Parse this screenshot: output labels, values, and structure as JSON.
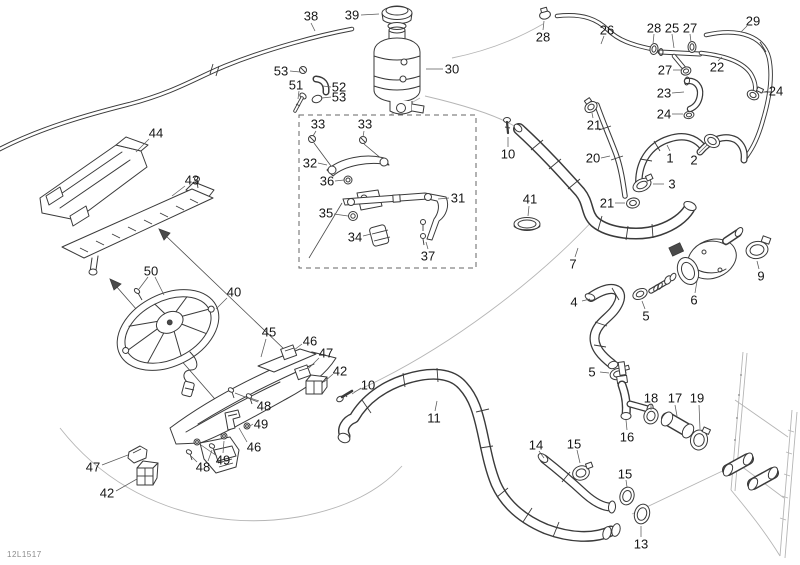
{
  "figure_code": "12L1517",
  "colors": {
    "line": "#3a3a3a",
    "label": "#161616",
    "guide": "#b5b5b5",
    "leader": "#5a5a5a",
    "background": "#ffffff"
  },
  "labels": [
    {
      "n": "38",
      "x": 311,
      "y": 16,
      "L": [
        [
          311,
          23,
          315,
          31
        ]
      ]
    },
    {
      "n": "39",
      "x": 352,
      "y": 15,
      "L": [
        [
          361,
          15,
          379,
          14
        ]
      ]
    },
    {
      "n": "30",
      "x": 452,
      "y": 69,
      "L": [
        [
          443,
          69,
          426,
          69
        ]
      ]
    },
    {
      "n": "53",
      "x": 281,
      "y": 71,
      "L": [
        [
          290,
          71,
          300,
          72
        ]
      ]
    },
    {
      "n": "51",
      "x": 296,
      "y": 85,
      "L": [
        [
          299,
          91,
          298,
          99
        ]
      ]
    },
    {
      "n": "52",
      "x": 339,
      "y": 87,
      "L": [
        [
          331,
          87,
          323,
          86
        ]
      ]
    },
    {
      "n": "53",
      "x": 339,
      "y": 97,
      "L": [
        [
          331,
          97,
          322,
          98
        ]
      ]
    },
    {
      "n": "28",
      "x": 543,
      "y": 37,
      "L": [
        [
          543,
          30,
          544,
          21
        ]
      ]
    },
    {
      "n": "26",
      "x": 607,
      "y": 30,
      "L": [
        [
          604,
          36,
          601,
          44
        ]
      ]
    },
    {
      "n": "28",
      "x": 654,
      "y": 28,
      "L": [
        [
          654,
          34,
          653,
          44
        ]
      ]
    },
    {
      "n": "25",
      "x": 672,
      "y": 28,
      "L": [
        [
          672,
          34,
          674,
          48
        ]
      ]
    },
    {
      "n": "27",
      "x": 690,
      "y": 28,
      "L": [
        [
          690,
          34,
          691,
          42
        ]
      ]
    },
    {
      "n": "29",
      "x": 753,
      "y": 21,
      "L": [
        [
          747,
          26,
          741,
          32
        ]
      ]
    },
    {
      "n": "27",
      "x": 665,
      "y": 70,
      "L": [
        [
          673,
          70,
          681,
          70
        ]
      ]
    },
    {
      "n": "22",
      "x": 717,
      "y": 67,
      "L": [
        [
          718,
          61,
          722,
          57
        ]
      ]
    },
    {
      "n": "23",
      "x": 664,
      "y": 93,
      "L": [
        [
          672,
          93,
          684,
          92
        ]
      ]
    },
    {
      "n": "24",
      "x": 776,
      "y": 91,
      "L": [
        [
          768,
          91,
          760,
          93
        ]
      ]
    },
    {
      "n": "24",
      "x": 664,
      "y": 114,
      "L": [
        [
          672,
          114,
          683,
          114
        ]
      ]
    },
    {
      "n": "21",
      "x": 594,
      "y": 125,
      "L": [
        [
          593,
          118,
          592,
          113
        ]
      ]
    },
    {
      "n": "20",
      "x": 593,
      "y": 158,
      "L": [
        [
          601,
          158,
          610,
          156
        ]
      ]
    },
    {
      "n": "1",
      "x": 670,
      "y": 158,
      "L": [
        [
          670,
          151,
          667,
          145
        ]
      ]
    },
    {
      "n": "2",
      "x": 694,
      "y": 160,
      "L": [
        [
          699,
          153,
          707,
          145
        ]
      ]
    },
    {
      "n": "3",
      "x": 672,
      "y": 184,
      "L": [
        [
          664,
          184,
          653,
          184
        ]
      ]
    },
    {
      "n": "21",
      "x": 607,
      "y": 203,
      "L": [
        [
          615,
          203,
          625,
          203
        ]
      ]
    },
    {
      "n": "10",
      "x": 508,
      "y": 154,
      "L": [
        [
          508,
          147,
          508,
          137
        ]
      ]
    },
    {
      "n": "41",
      "x": 530,
      "y": 199,
      "L": [
        [
          529,
          206,
          528,
          216
        ]
      ]
    },
    {
      "n": "7",
      "x": 573,
      "y": 264,
      "L": [
        [
          575,
          257,
          578,
          248
        ]
      ]
    },
    {
      "n": "4",
      "x": 574,
      "y": 302,
      "L": [
        [
          582,
          301,
          590,
          299
        ]
      ]
    },
    {
      "n": "5",
      "x": 646,
      "y": 316,
      "L": [
        [
          645,
          309,
          642,
          301
        ]
      ]
    },
    {
      "n": "6",
      "x": 694,
      "y": 300,
      "L": [
        [
          695,
          293,
          697,
          281
        ]
      ]
    },
    {
      "n": "9",
      "x": 761,
      "y": 276,
      "L": [
        [
          759,
          269,
          757,
          261
        ]
      ]
    },
    {
      "n": "5",
      "x": 592,
      "y": 372,
      "L": [
        [
          600,
          372,
          609,
          373
        ]
      ]
    },
    {
      "n": "16",
      "x": 627,
      "y": 437,
      "L": [
        [
          627,
          430,
          626,
          420
        ]
      ]
    },
    {
      "n": "18",
      "x": 651,
      "y": 398,
      "L": [
        [
          651,
          404,
          651,
          410
        ]
      ]
    },
    {
      "n": "17",
      "x": 675,
      "y": 398,
      "L": [
        [
          675,
          405,
          677,
          416
        ]
      ]
    },
    {
      "n": "19",
      "x": 697,
      "y": 398,
      "L": [
        [
          699,
          405,
          700,
          429
        ]
      ]
    },
    {
      "n": "15",
      "x": 574,
      "y": 444,
      "L": [
        [
          577,
          450,
          580,
          463
        ]
      ]
    },
    {
      "n": "14",
      "x": 536,
      "y": 445,
      "L": [
        [
          539,
          451,
          544,
          458
        ]
      ]
    },
    {
      "n": "15",
      "x": 625,
      "y": 474,
      "L": [
        [
          626,
          480,
          627,
          487
        ]
      ]
    },
    {
      "n": "13",
      "x": 641,
      "y": 544,
      "L": [
        [
          641,
          537,
          641,
          526
        ]
      ]
    },
    {
      "n": "44",
      "x": 156,
      "y": 133,
      "L": [
        [
          149,
          139,
          136,
          152
        ]
      ]
    },
    {
      "n": "43",
      "x": 192,
      "y": 180,
      "L": [
        [
          185,
          186,
          172,
          196
        ]
      ]
    },
    {
      "n": "50",
      "x": 151,
      "y": 271,
      "L": [
        [
          148,
          277,
          139,
          289
        ],
        [
          155,
          277,
          164,
          295
        ]
      ]
    },
    {
      "n": "40",
      "x": 234,
      "y": 292,
      "L": [
        [
          227,
          298,
          216,
          309
        ]
      ]
    },
    {
      "n": "45",
      "x": 269,
      "y": 332,
      "L": [
        [
          266,
          339,
          261,
          357
        ]
      ]
    },
    {
      "n": "46",
      "x": 310,
      "y": 341,
      "L": [
        [
          302,
          344,
          294,
          350
        ]
      ]
    },
    {
      "n": "47",
      "x": 326,
      "y": 353,
      "L": [
        [
          319,
          358,
          309,
          368
        ]
      ]
    },
    {
      "n": "42",
      "x": 340,
      "y": 371,
      "L": [
        [
          333,
          374,
          324,
          382
        ]
      ]
    },
    {
      "n": "10",
      "x": 368,
      "y": 385,
      "L": [
        [
          361,
          388,
          352,
          394
        ]
      ]
    },
    {
      "n": "11",
      "x": 434,
      "y": 418,
      "L": [
        [
          435,
          411,
          437,
          401
        ]
      ]
    },
    {
      "n": "48",
      "x": 264,
      "y": 406,
      "L": [
        [
          259,
          401,
          250,
          398
        ],
        [
          258,
          402,
          235,
          393
        ]
      ]
    },
    {
      "n": "49",
      "x": 261,
      "y": 424,
      "L": [
        [
          253,
          424,
          250,
          426
        ]
      ]
    },
    {
      "n": "46",
      "x": 254,
      "y": 447,
      "L": [
        [
          247,
          442,
          239,
          428
        ]
      ]
    },
    {
      "n": "49",
      "x": 223,
      "y": 460,
      "L": [
        [
          223,
          453,
          224,
          441
        ],
        [
          217,
          456,
          201,
          445
        ]
      ]
    },
    {
      "n": "48",
      "x": 203,
      "y": 467,
      "L": [
        [
          197,
          462,
          191,
          456
        ],
        [
          208,
          461,
          212,
          450
        ]
      ]
    },
    {
      "n": "47",
      "x": 93,
      "y": 467,
      "L": [
        [
          102,
          465,
          128,
          455
        ]
      ]
    },
    {
      "n": "42",
      "x": 107,
      "y": 493,
      "L": [
        [
          116,
          491,
          137,
          479
        ]
      ]
    },
    {
      "n": "33",
      "x": 318,
      "y": 124,
      "L": [
        [
          316,
          131,
          313,
          136
        ]
      ]
    },
    {
      "n": "33",
      "x": 365,
      "y": 124,
      "L": [
        [
          364,
          131,
          363,
          137
        ]
      ]
    },
    {
      "n": "32",
      "x": 310,
      "y": 163,
      "L": [
        [
          318,
          163,
          327,
          165
        ]
      ]
    },
    {
      "n": "36",
      "x": 327,
      "y": 181,
      "L": [
        [
          335,
          181,
          344,
          180
        ]
      ]
    },
    {
      "n": "31",
      "x": 458,
      "y": 198,
      "L": [
        [
          449,
          198,
          438,
          199
        ]
      ]
    },
    {
      "n": "35",
      "x": 326,
      "y": 213,
      "L": [
        [
          334,
          214,
          348,
          216
        ]
      ]
    },
    {
      "n": "34",
      "x": 355,
      "y": 237,
      "L": [
        [
          363,
          236,
          371,
          234
        ]
      ]
    },
    {
      "n": "37",
      "x": 428,
      "y": 256,
      "L": [
        [
          428,
          249,
          426,
          242
        ]
      ]
    }
  ]
}
